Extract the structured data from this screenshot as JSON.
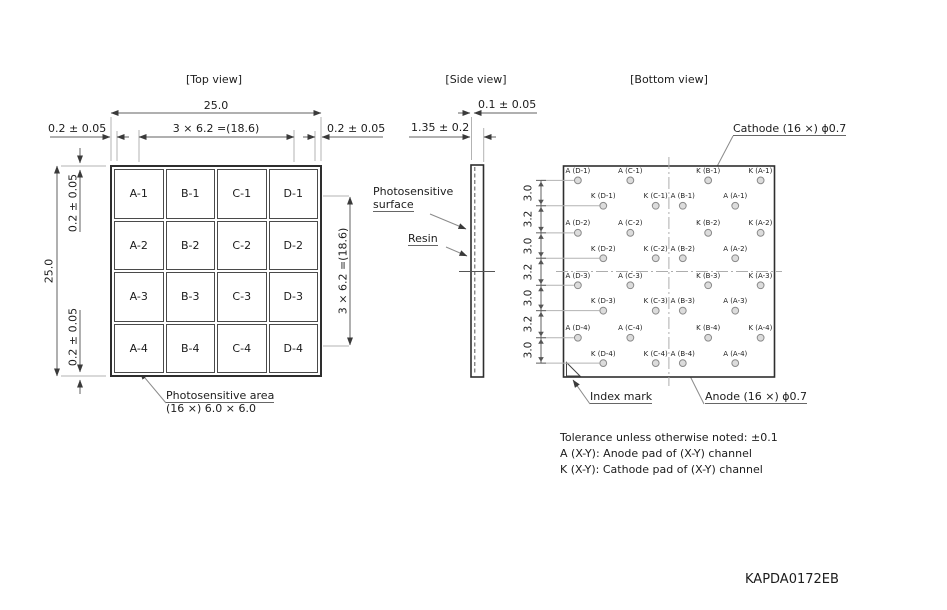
{
  "part_number": "KAPDA0172EB",
  "colors": {
    "line_dark": "#2e2e2e",
    "line_dim": "#606060",
    "pad_fill": "#dcdcdc"
  },
  "top_view": {
    "title": "[Top view]",
    "cells": [
      "A-1",
      "B-1",
      "C-1",
      "D-1",
      "A-2",
      "B-2",
      "C-2",
      "D-2",
      "A-3",
      "B-3",
      "C-3",
      "D-3",
      "A-4",
      "B-4",
      "C-4",
      "D-4"
    ],
    "dim_width": "25.0",
    "dim_height": "25.0",
    "dim_pitch_h": "3 × 6.2 =(18.6)",
    "dim_pitch_v": "3 × 6.2 =(18.6)",
    "dim_edge_left": "0.2 ± 0.05",
    "dim_edge_right": "0.2 ± 0.05",
    "dim_edge_top": "0.2 ± 0.05",
    "dim_edge_bottom": "0.2 ± 0.05",
    "area_label_line1": "Photosensitive area",
    "area_label_line2": "(16 ×) 6.0 × 6.0"
  },
  "side_view": {
    "title": "[Side view]",
    "dim_surface_offset": "0.1 ± 0.05",
    "dim_thickness": "1.35 ± 0.2",
    "label_surface_line1": "Photosensitive",
    "label_surface_line2": "surface",
    "label_resin": "Resin"
  },
  "bottom_view": {
    "title": "[Bottom view]",
    "cathode_label": "Cathode (16 ×) ϕ0.7",
    "anode_label": "Anode (16 ×) ϕ0.7",
    "index_mark_label": "Index mark",
    "pitch_chain": [
      "3.0",
      "3.2",
      "3.0",
      "3.2",
      "3.0",
      "3.2",
      "3.0"
    ],
    "edge_offset_units": 1.7,
    "pad_rows": [
      {
        "cols": [
          0,
          2,
          5,
          7
        ],
        "labels": [
          "A (D-1)",
          "A (C-1)",
          "K (B-1)",
          "K (A-1)"
        ]
      },
      {
        "cols": [
          1,
          3,
          4,
          6
        ],
        "labels": [
          "K (D-1)",
          "K (C-1)",
          "A (B-1)",
          "A (A-1)"
        ]
      },
      {
        "cols": [
          0,
          2,
          5,
          7
        ],
        "labels": [
          "A (D-2)",
          "A (C-2)",
          "K (B-2)",
          "K (A-2)"
        ]
      },
      {
        "cols": [
          1,
          3,
          4,
          6
        ],
        "labels": [
          "K (D-2)",
          "K (C-2)",
          "A (B-2)",
          "A (A-2)"
        ]
      },
      {
        "cols": [
          0,
          2,
          5,
          7
        ],
        "labels": [
          "A (D-3)",
          "A (C-3)",
          "K (B-3)",
          "K (A-3)"
        ]
      },
      {
        "cols": [
          1,
          3,
          4,
          6
        ],
        "labels": [
          "K (D-3)",
          "K (C-3)",
          "A (B-3)",
          "A (A-3)"
        ]
      },
      {
        "cols": [
          0,
          2,
          5,
          7
        ],
        "labels": [
          "A (D-4)",
          "A (C-4)",
          "K (B-4)",
          "K (A-4)"
        ]
      },
      {
        "cols": [
          1,
          3,
          4,
          6
        ],
        "labels": [
          "K (D-4)",
          "K (C-4)",
          "A (B-4)",
          "A (A-4)"
        ]
      }
    ]
  },
  "notes": [
    "Tolerance unless otherwise noted: ±0.1",
    "A (X-Y): Anode pad of (X-Y) channel",
    "K (X-Y): Cathode pad of (X-Y) channel"
  ]
}
